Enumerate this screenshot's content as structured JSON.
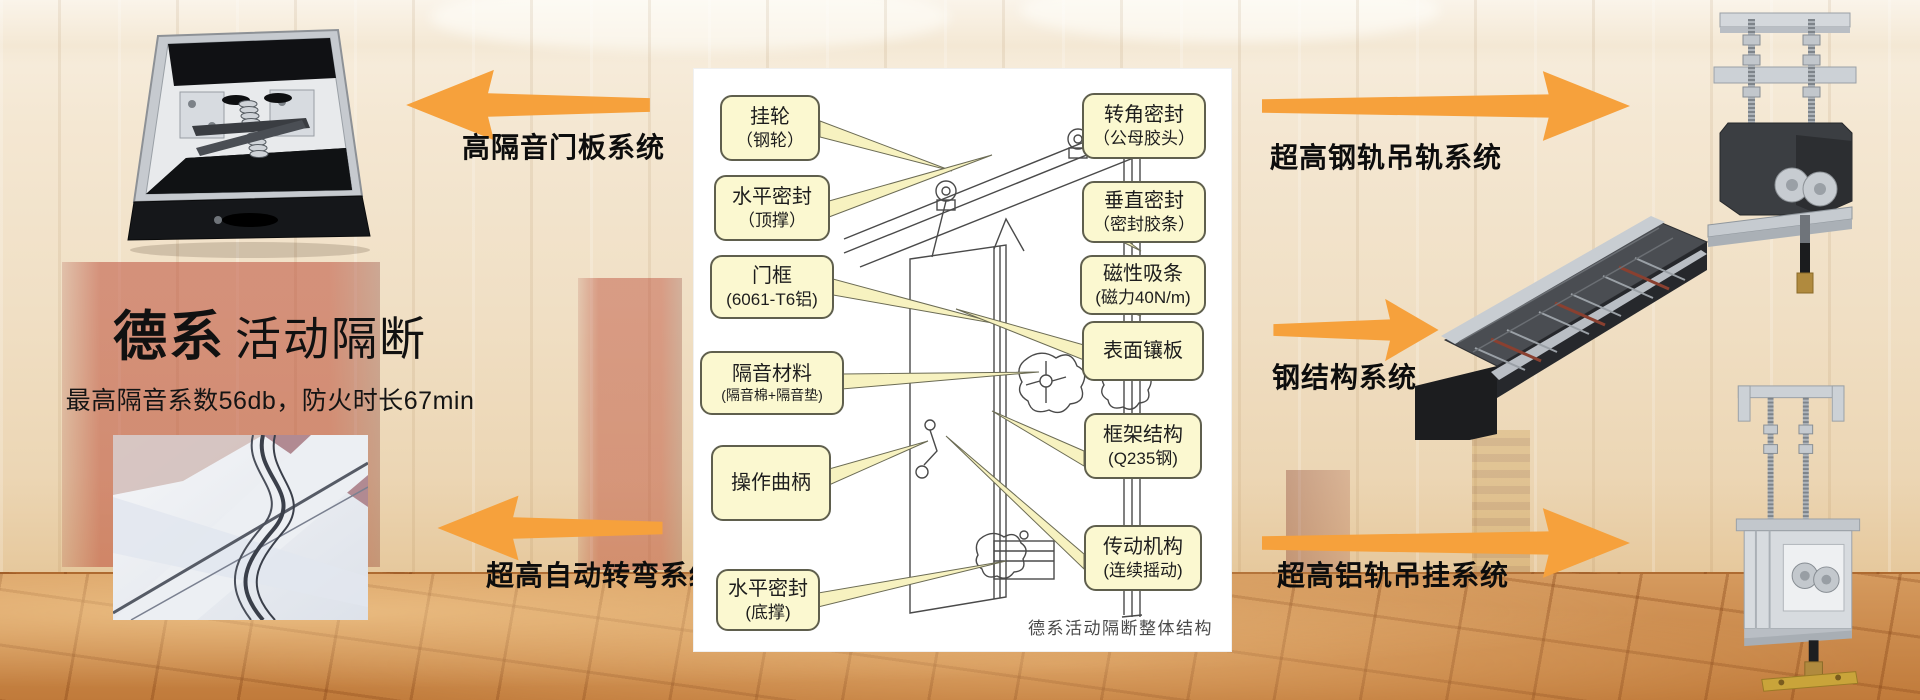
{
  "brand": {
    "title_bold": "德系",
    "title_light": "活动隔断",
    "subtitle": "最高隔音系数56db，防火时长67min"
  },
  "arrows": {
    "left_top": "高隔音门板系统",
    "left_bottom": "超高自动转弯系统",
    "right_top": "超高钢轨吊轨系统",
    "right_middle": "钢结构系统",
    "right_bottom": "超高铝轨吊挂系统"
  },
  "diagram": {
    "caption": "德系活动隔断整体结构",
    "callouts_left": [
      {
        "line1": "挂轮",
        "line2": "（钢轮）"
      },
      {
        "line1": "水平密封",
        "line2": "（顶撑）"
      },
      {
        "line1": "门框",
        "line2": "(6061-T6铝)"
      },
      {
        "line1": "隔音材料",
        "line2": "(隔音棉+隔音垫)"
      },
      {
        "line1": "操作曲柄",
        "line2": ""
      },
      {
        "line1": "水平密封",
        "line2": "(底撑)"
      }
    ],
    "callouts_right": [
      {
        "line1": "转角密封",
        "line2": "（公母胶头）"
      },
      {
        "line1": "垂直密封",
        "line2": "（密封胶条）"
      },
      {
        "line1": "磁性吸条",
        "line2": "(磁力40N/m)"
      },
      {
        "line1": "表面镶板",
        "line2": ""
      },
      {
        "line1": "框架结构",
        "line2": "(Q235钢)"
      },
      {
        "line1": "传动机构",
        "line2": "(连续摇动)"
      }
    ]
  },
  "images": {
    "top_left": "door-panel-cross-section-photo",
    "bottom_left": "curved-track-photo",
    "top_right": "steel-rail-trolley-photo",
    "middle_right": "steel-frame-structure-photo",
    "bottom_right": "aluminum-rail-hanger-photo"
  },
  "colors": {
    "arrow": "#F6A13C",
    "callout_bg": "#FBF8D0",
    "callout_border": "#5F5F4D",
    "panel_bg": "#FFFFFF"
  }
}
